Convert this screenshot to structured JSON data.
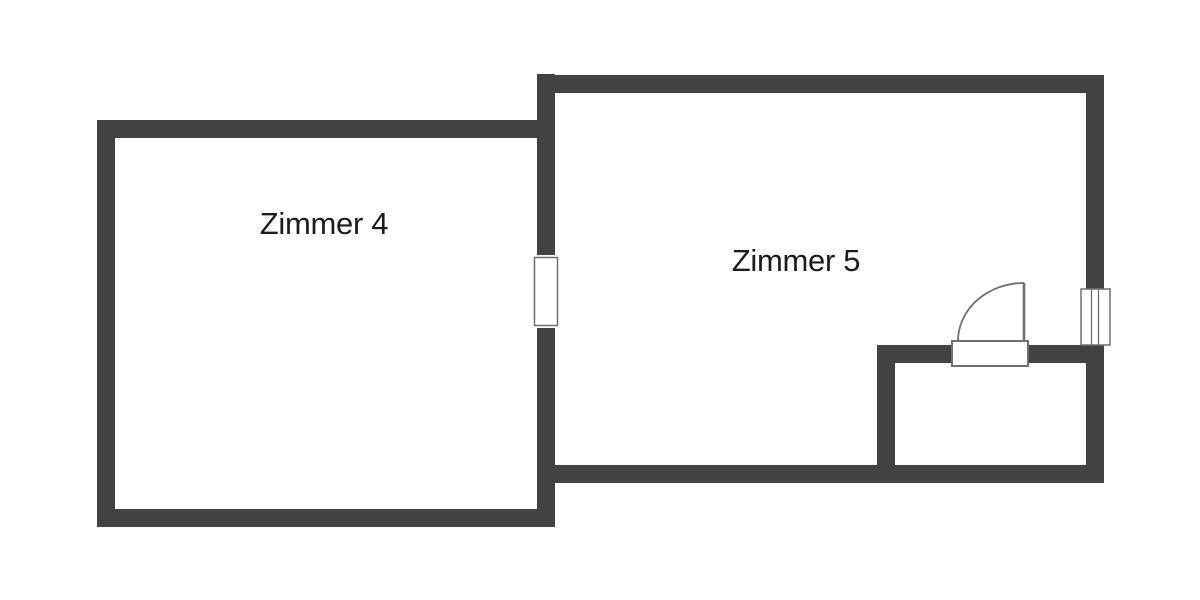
{
  "floorplan": {
    "background": "#ffffff",
    "colors": {
      "wall": "#424242",
      "symbol_stroke": "#6f6f6f",
      "symbol_fill": "#ffffff",
      "label": "#1c1c1c"
    },
    "rooms": [
      {
        "id": "zimmer-4",
        "label": "Zimmer 4"
      },
      {
        "id": "zimmer-5",
        "label": "Zimmer 5"
      }
    ],
    "symbols": {
      "door": "door-swing-into-zimmer-5",
      "window": "window-right-wall",
      "opening": "wall-opening-between-rooms"
    }
  }
}
